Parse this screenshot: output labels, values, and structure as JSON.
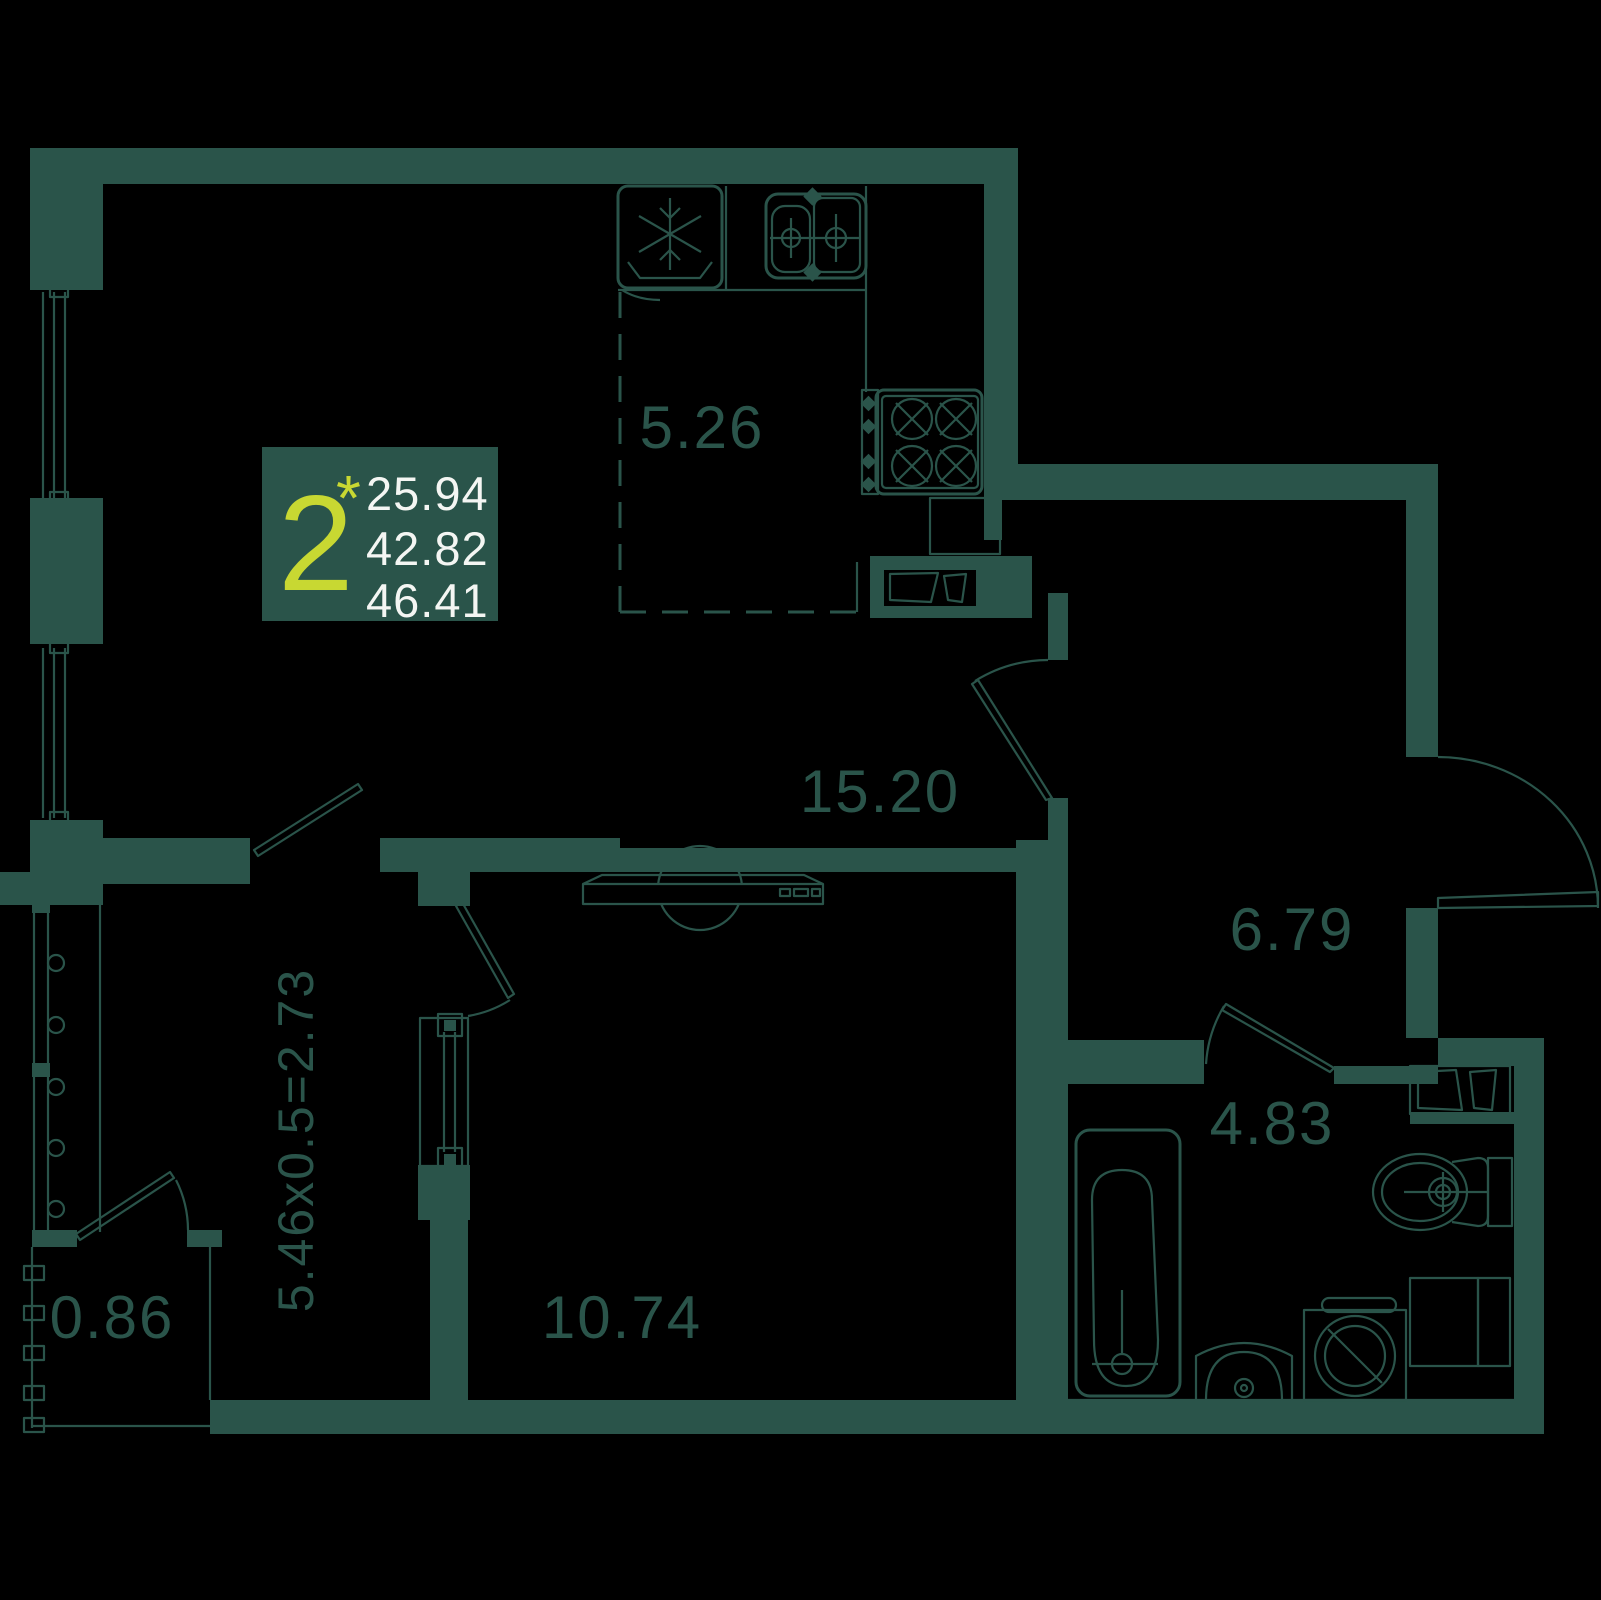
{
  "plan": {
    "title": "2-room apartment floor plan",
    "info_box": {
      "rooms_count": "2",
      "asterisk": "*",
      "living_area": "25.94",
      "apartment_area": "42.82",
      "total_area": "46.41"
    },
    "rooms": [
      {
        "id": "kitchen",
        "area": "5.26"
      },
      {
        "id": "living",
        "area": "15.20"
      },
      {
        "id": "hallway",
        "area": "6.79"
      },
      {
        "id": "bathroom",
        "area": "4.83"
      },
      {
        "id": "bedroom",
        "area": "10.74"
      },
      {
        "id": "balcony",
        "area": "0.86"
      }
    ],
    "loggia_dimension": "5.46x0.5=2.73",
    "colors": {
      "background": "#000000",
      "wall": "#2a544a",
      "accent": "#c8d832",
      "text_light": "#f4f6f3"
    }
  }
}
